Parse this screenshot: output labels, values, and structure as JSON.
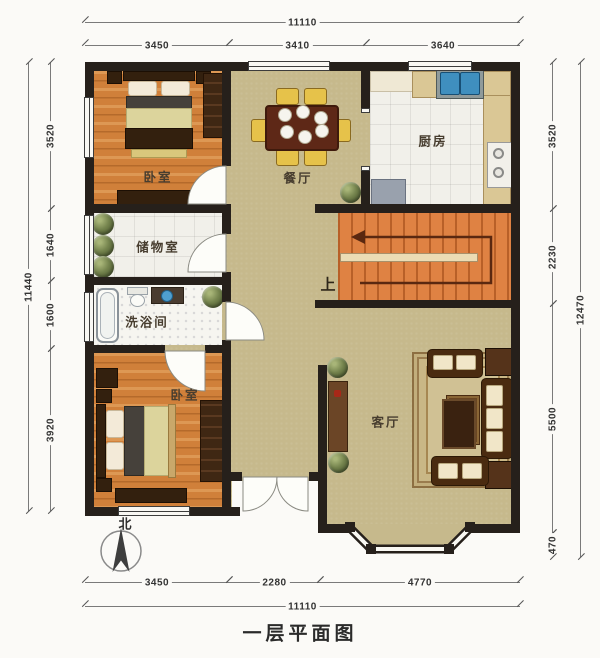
{
  "title": "一层平面图",
  "compass": {
    "north": "北"
  },
  "rooms": {
    "bedroom_top": {
      "label": "卧室"
    },
    "dining": {
      "label": "餐厅"
    },
    "kitchen": {
      "label": "厨房"
    },
    "storage": {
      "label": "储物室"
    },
    "bathroom": {
      "label": "洗浴间"
    },
    "bedroom_bottom": {
      "label": "卧室"
    },
    "living": {
      "label": "客厅"
    }
  },
  "stairs": {
    "up_label": "上"
  },
  "dimensions": {
    "top": {
      "total": "11110",
      "segments": [
        "3450",
        "3410",
        "3640"
      ]
    },
    "bottom": {
      "total": "11110",
      "segments": [
        "3450",
        "2280",
        "4770"
      ]
    },
    "left": {
      "total": "11440",
      "segments": [
        "3520",
        "1640",
        "1600",
        "3920"
      ]
    },
    "right": {
      "total": "12470",
      "segments": [
        "3520",
        "2230",
        "5500",
        "470"
      ]
    }
  },
  "colors": {
    "wall": "#26201b",
    "wood_floor": "#d0803a",
    "hall_floor": "#c6b98c",
    "tile_floor": "#f1f0ea",
    "stairs": "#df8243",
    "sink_blue": "#3f8fbf",
    "plant_green": "#74834d",
    "dim_text": "#333333"
  }
}
